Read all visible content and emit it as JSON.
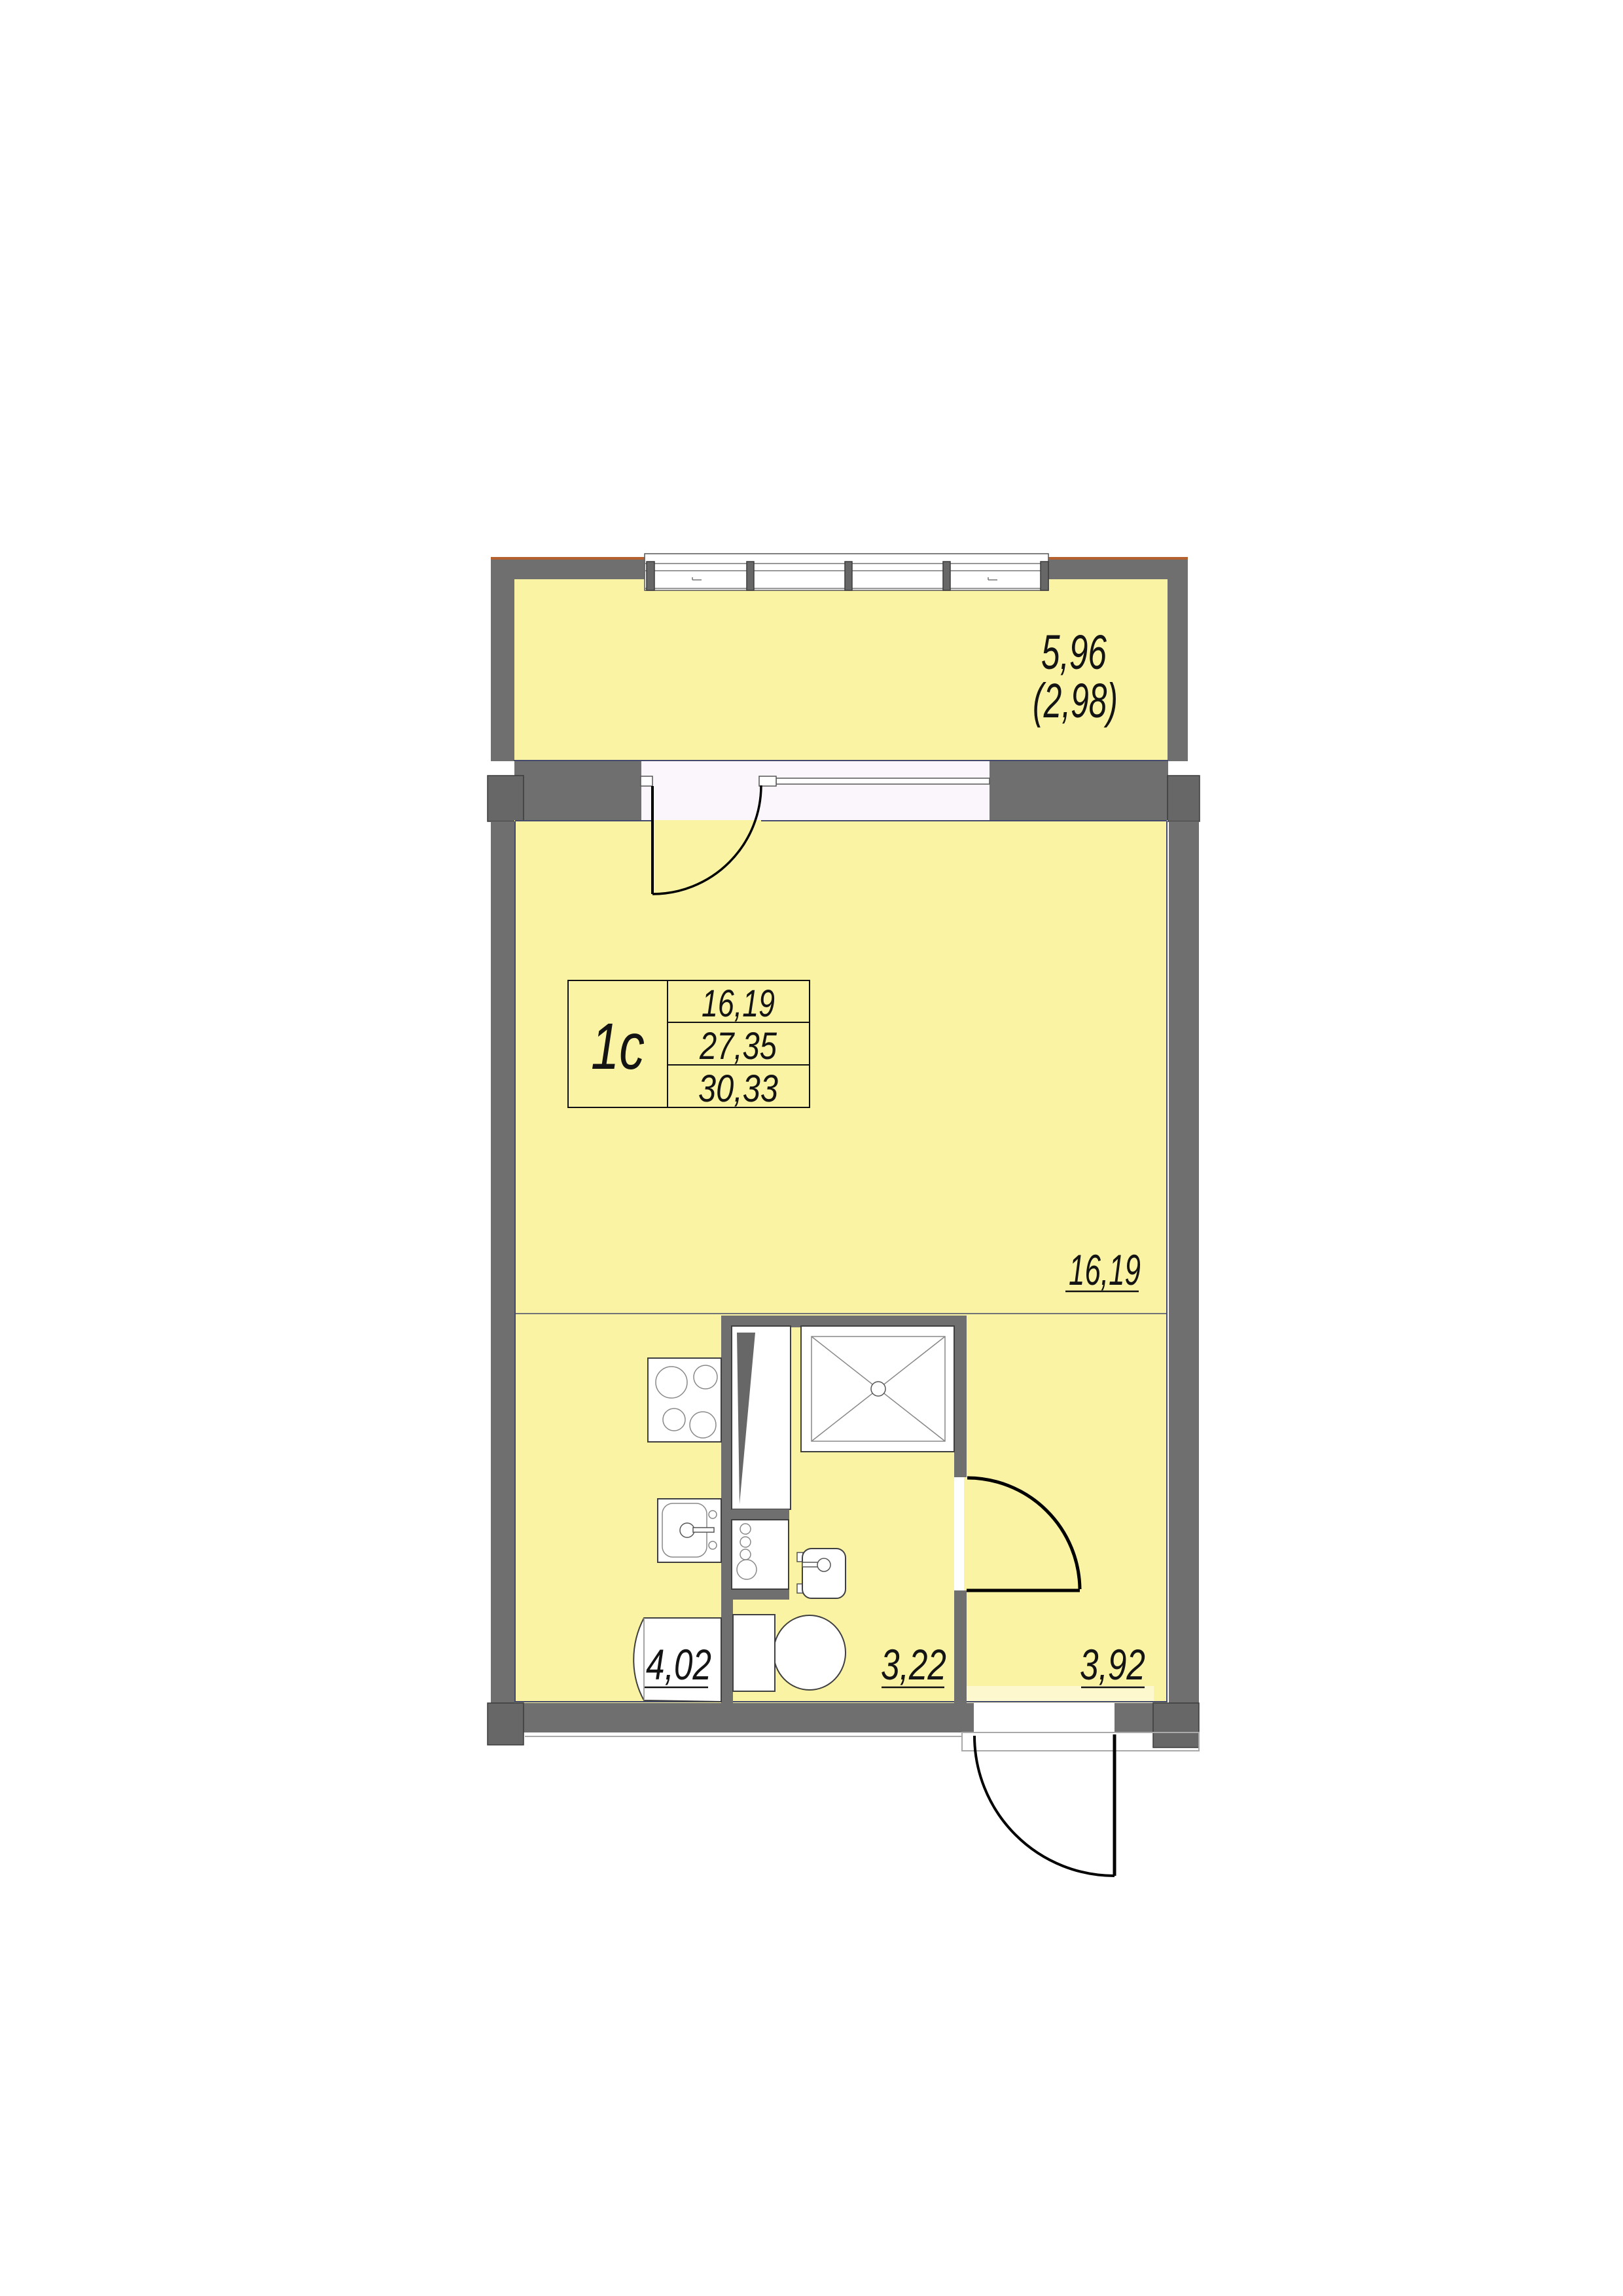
{
  "colors": {
    "floor": "#faf3a3",
    "floor_light": "#fdf8cd",
    "wall": "#6f6f6f",
    "pilaster": "#676767",
    "cavity": "#fbf6fc",
    "line": "#434a6b",
    "accent": "#b5602f",
    "fixture": "#3f3f3f",
    "door": "#000000",
    "text": "#141414"
  },
  "unit_table": {
    "unit_type": "1с",
    "living_area": "16,19",
    "floor_area": "27,35",
    "total_area": "30,33"
  },
  "labels": {
    "balcony_area": "5,96",
    "balcony_area_reduced": "(2,98)",
    "living_room_area": "16,19",
    "kitchen_area": "4,02",
    "bathroom_area": "3,22",
    "hallway_area": "3,92"
  }
}
